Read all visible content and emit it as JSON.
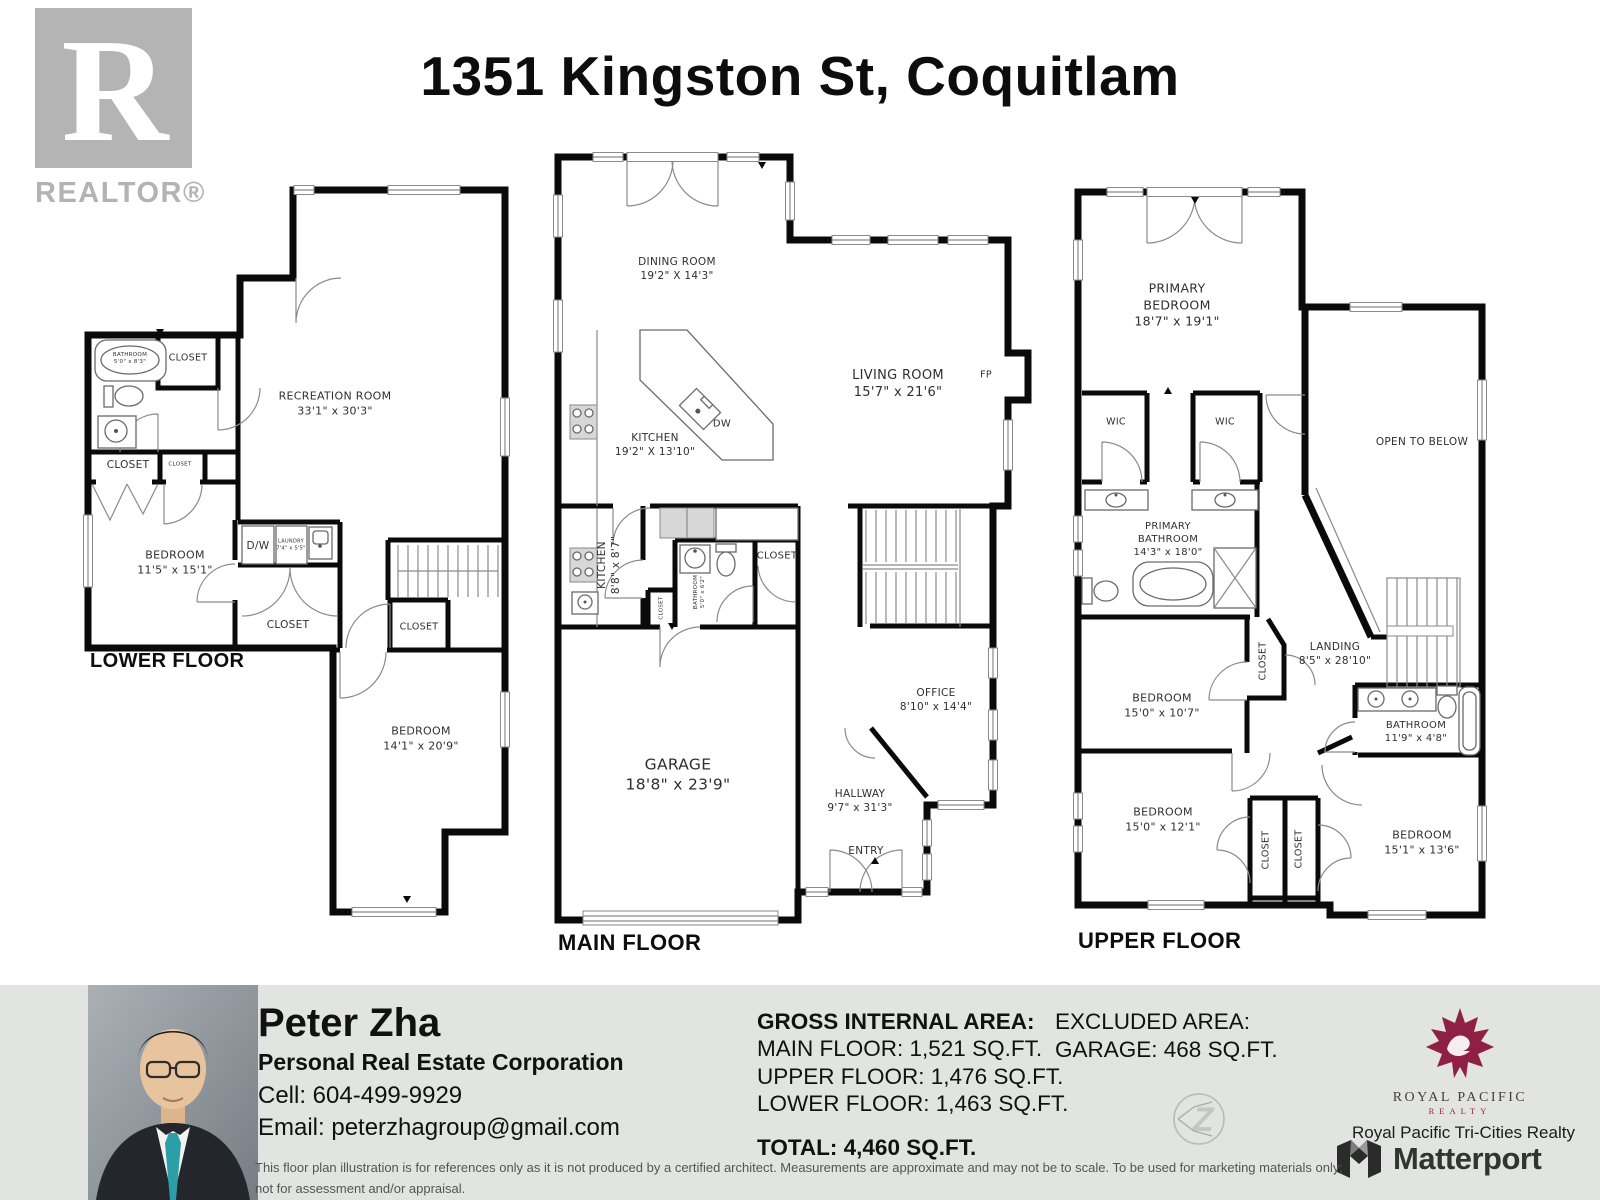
{
  "header": {
    "title": "1351 Kingston St, Coquitlam",
    "realtor_logo": {
      "letter": "R",
      "label": "REALTOR®"
    }
  },
  "common": {
    "closet": "CLOSET",
    "wic": "WIC",
    "dw": "D/W",
    "dw_island": "DW",
    "fp": "FP",
    "entry": "ENTRY",
    "open_to_below": "OPEN TO BELOW"
  },
  "floors": {
    "lower": {
      "name": "LOWER FLOOR",
      "recreation": {
        "label": "RECREATION ROOM",
        "dims": "33'1\" x 30'3\""
      },
      "bathroom": {
        "label": "BATHROOM",
        "dims": "5'0\" x 8'3\""
      },
      "bedroom1": {
        "label": "BEDROOM",
        "dims": "11'5\" x 15'1\""
      },
      "laundry": {
        "label": "LAUNDRY",
        "dims": "7'4\" x 5'5\""
      },
      "bedroom2": {
        "label": "BEDROOM",
        "dims": "14'1\" x 20'9\""
      }
    },
    "main": {
      "name": "MAIN FLOOR",
      "dining": {
        "label": "DINING ROOM",
        "dims": "19'2\" X 14'3\""
      },
      "kitchen": {
        "label": "KITCHEN",
        "dims": "19'2\" X 13'10\""
      },
      "living": {
        "label": "LIVING ROOM",
        "dims": "15'7\" x 21'6\""
      },
      "kitchen2": {
        "label": "KITCHEN",
        "dims": "8'8\" x 8'7\""
      },
      "bathroom": {
        "label": "BATHROOM",
        "dims": "5'0\" x 6'2\""
      },
      "office": {
        "label": "OFFICE",
        "dims": "8'10\" x 14'4\""
      },
      "hallway": {
        "label": "HALLWAY",
        "dims": "9'7\" x 31'3\""
      },
      "garage": {
        "label": "GARAGE",
        "dims": "18'8\" x 23'9\""
      }
    },
    "upper": {
      "name": "UPPER FLOOR",
      "primary_bedroom": {
        "label1": "PRIMARY",
        "label2": "BEDROOM",
        "dims": "18'7\" x 19'1\""
      },
      "primary_bathroom": {
        "label1": "PRIMARY",
        "label2": "BATHROOM",
        "dims": "14'3\" x 18'0\""
      },
      "landing": {
        "label": "LANDING",
        "dims": "8'5\" x 28'10\""
      },
      "bedroom1": {
        "label": "BEDROOM",
        "dims": "15'0\" x 10'7\""
      },
      "bathroom": {
        "label": "BATHROOM",
        "dims": "11'9\" x 4'8\""
      },
      "bedroom2": {
        "label": "BEDROOM",
        "dims": "15'0\" x 12'1\""
      },
      "bedroom3": {
        "label": "BEDROOM",
        "dims": "15'1\" x 13'6\""
      }
    }
  },
  "footer": {
    "agent": {
      "name": "Peter Zha",
      "title": "Personal Real Estate Corporation",
      "cell": "Cell: 604-499-9929",
      "email": "Email: peterzhagroup@gmail.com"
    },
    "areas": {
      "gross_heading": "GROSS INTERNAL AREA:",
      "main": "MAIN FLOOR: 1,521 SQ.FT.",
      "upper": "UPPER FLOOR: 1,476 SQ.FT.",
      "lower": "LOWER FLOOR: 1,463 SQ.FT.",
      "total": "TOTAL: 4,460 SQ.FT.",
      "excluded_heading": "EXCLUDED AREA:",
      "excluded_garage": "GARAGE: 468 SQ.FT."
    },
    "brokerage": {
      "logo_line1": "ROYAL PACIFIC",
      "logo_line2": "REALTY",
      "name": "Royal Pacific Tri-Cities Realty"
    },
    "matterport": "Matterport",
    "z_watermark": "Z",
    "disclaimer_line1": "This floor plan illustration is for references only as it is not produced by a certified architect. Measurements are approximate and may not be to scale. To be used for marketing materials only;",
    "disclaimer_line2": "not for assessment and/or appraisal."
  }
}
